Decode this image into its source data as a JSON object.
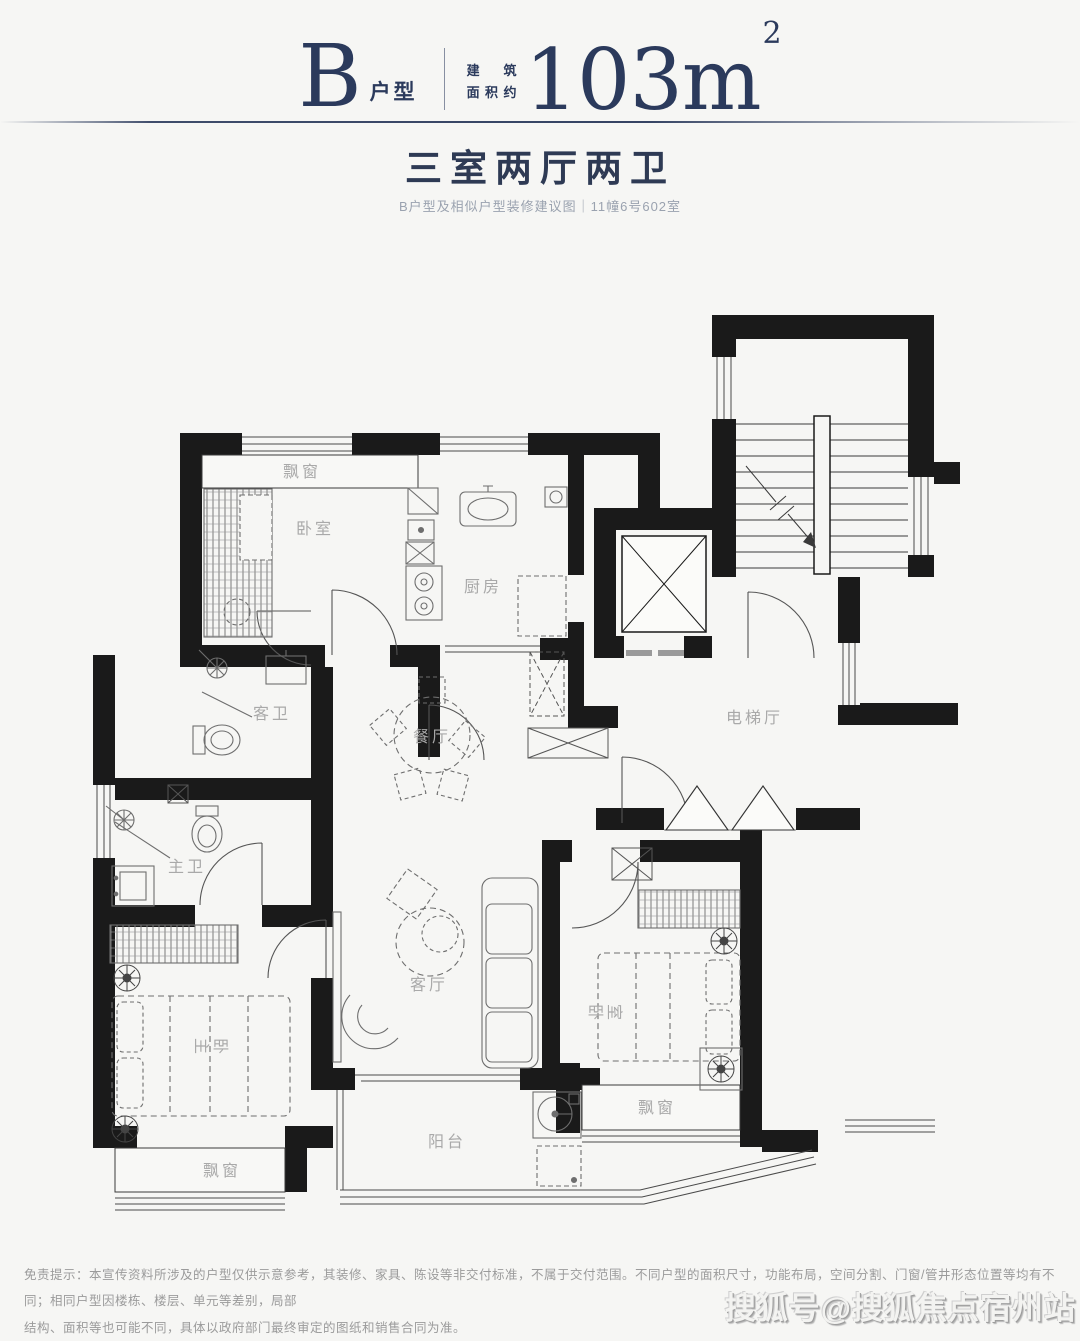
{
  "colors": {
    "accent_navy": "#2b3a5c",
    "wall_black": "#1a1a1a",
    "label_gray": "#a9a9a9",
    "furniture_gray": "#6e6e6e",
    "background": "#f6f6f4"
  },
  "header": {
    "plan_letter": "B",
    "plan_letter_suffix": "户型",
    "area_label_line1": "建筑",
    "area_label_line2": "面积约",
    "area_value": "103m",
    "area_superscript": "2"
  },
  "summary": {
    "title": "三室两厅两卫",
    "subtitle": "B户型及相似户型装修建议图｜11幢6号602室"
  },
  "floorplan": {
    "labels": {
      "bay_top": "飘窗",
      "bedroom_top": "卧室",
      "kitchen": "厨房",
      "guest_bath": "客卫",
      "dining": "餐厅",
      "elevator_hall": "电梯厅",
      "master_bath": "主卫",
      "master_bedroom": "主卧",
      "living": "客厅",
      "bedroom_right": "卧室",
      "bay_right": "飘窗",
      "balcony": "阳台",
      "bay_left": "飘窗"
    }
  },
  "footer": {
    "disclaimer_line1": "免责提示：本宣传资料所涉及的户型仅供示意参考，其装修、家具、陈设等非交付标准，不属于交付范围。不同户型的面积尺寸，功能布局，空间分割、门窗/管井形态位置等均有不同；相同户型因楼栋、楼层、单元等差别，局部",
    "disclaimer_line2": "结构、面积等也可能不同，具体以政府部门最终审定的图纸和销售合同为准。"
  },
  "watermark": {
    "text": "搜狐号@搜狐焦点宿州站"
  }
}
